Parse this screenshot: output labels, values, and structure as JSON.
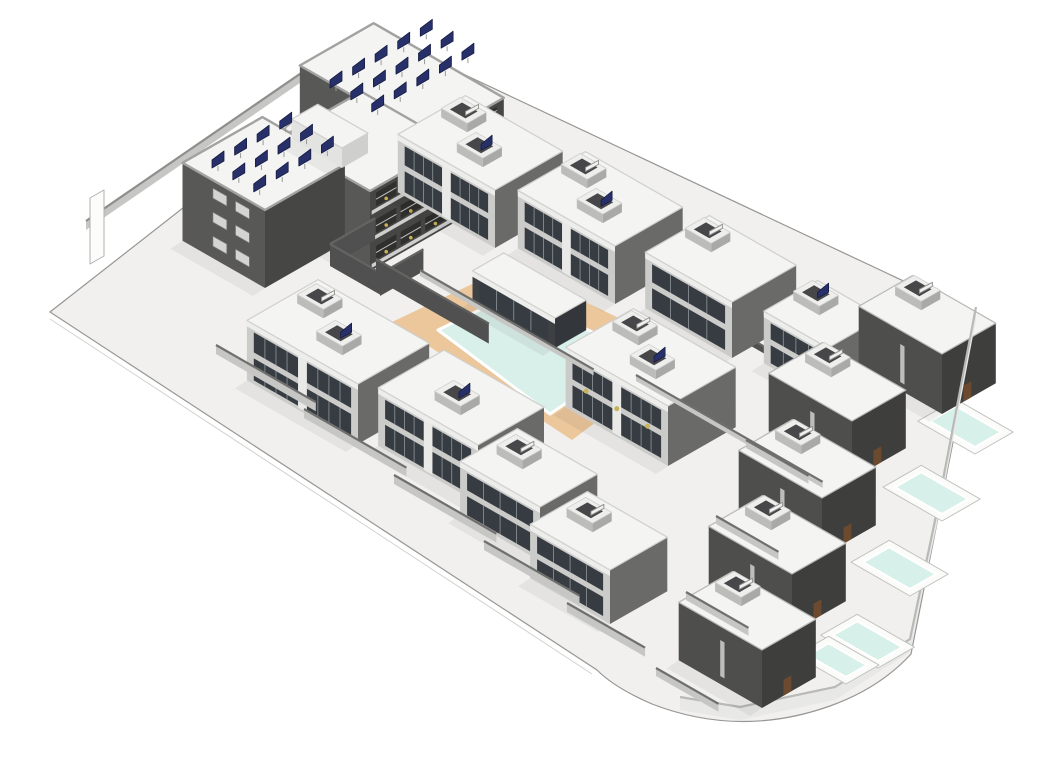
{
  "render": {
    "kind": "architectural-3d-site-render",
    "width": 1057,
    "height": 747
  },
  "palette": {
    "page_bg": "#ffffff",
    "ground": "#f1f0ee",
    "ground_edge": "#969694",
    "ground_edge_faint": "#d2d2d0",
    "roof_white": "#f4f4f2",
    "roof_stroke": "#cfcfcd",
    "hotel_sw": "#585856",
    "hotel_se": "#464644",
    "hotel_parapet": "#a2a2a0",
    "villa_sw": "#cbcbc9",
    "villa_se": "#6a6a68",
    "villa_fascia": "#ededeb",
    "dark_sw": "#4e4e4c",
    "dark_se": "#3e3e3c",
    "pavilion_sw": "#3d4144",
    "pavilion_se": "#33363a",
    "glass": "#363c42",
    "glass_frame": "#8f979b",
    "mullion_white": "#e9e9e7",
    "well_sw": "#bcbcba",
    "well_se": "#a9a9a7",
    "well_top": "#eeeeec",
    "well_inner": "#47474a",
    "solar_navy": "#273069",
    "solar_stroke": "#161c45",
    "equip_white": "#f1f1ef",
    "equip_stroke": "#8e8e8c",
    "deck_tan": "#ecc79c",
    "deck_step": "#d9aa74",
    "water_main": "#d9efe9",
    "water_rim": "#ffffff",
    "pool_slab": "#fbfbf9",
    "pool_slab_stroke": "#c2c2c0",
    "pool_water": "#d8f0ea",
    "low_wall_face": "#c6c6c4",
    "low_wall_cap": "#6f6f6d",
    "dark_wall_face": "#505050",
    "dark_wall_cap": "#646462",
    "bound_face": "#e8e8e6",
    "bound_cap": "#b9b9b7",
    "balcony_slab": "#cfcfcd",
    "balcony_dark": "#2f2f2d",
    "balcony_rail": "#bfbfbd",
    "plant_yellow": "#c9b357",
    "louver": "#d4d4d2",
    "louver_line": "#77777f",
    "shadow": "rgba(0,0,0,0.05)"
  },
  "scene": {
    "ground_path": "M355,26 L938,300 L871,638 Q840,672 790,690 Q700,722 612,688 Q575,672 557,654 L10,296 Z",
    "ground_step_line": "M10,303 L552,658",
    "curve_curb": "M866,636 Q836,668 788,686 Q702,718 616,684",
    "deck_steps": "M436,262 L466,247 M431,268 L462,252 M426,274 L458,257",
    "elements": [
      {
        "kind": "wallpath",
        "name": "left-boundary-wall",
        "pts": [
          [
            46,
            214
          ],
          [
            334,
            16
          ]
        ],
        "h": 9,
        "face": "@low_wall_face",
        "cap": "@equip_stroke"
      },
      {
        "kind": "flat",
        "name": "entrance-sign",
        "pts": [
          [
            50,
            182
          ],
          [
            64,
            174
          ],
          [
            64,
            240
          ],
          [
            50,
            248
          ]
        ],
        "fill": "#fcfcfa",
        "stroke": "#b0b0ae"
      },
      {
        "kind": "box",
        "name": "hotel-wing-north",
        "c": [
          390,
          195
        ],
        "wa": 150,
        "wb": 85,
        "h": 71,
        "style": "hotel",
        "balconies": true
      },
      {
        "kind": "box",
        "name": "hotel-wing-middle",
        "c": [
          330,
          255
        ],
        "wa": 105,
        "wb": 95,
        "h": 80,
        "style": "hotel",
        "balconies": true
      },
      {
        "kind": "box",
        "name": "hotel-wing-west",
        "c": [
          225,
          272
        ],
        "wa": 95,
        "wb": 92,
        "h": 78,
        "style": "hotel",
        "louvers": true
      },
      {
        "kind": "box",
        "name": "hotel-penthouse",
        "c": [
          302,
          152
        ],
        "wa": 58,
        "wb": 30,
        "h": 20,
        "style": "white"
      },
      {
        "kind": "panels",
        "name": "solar-array-north-roof",
        "o": [
          290,
          72
        ],
        "rows": 3,
        "cols": 5,
        "sa": 24,
        "sb": 26
      },
      {
        "kind": "panels",
        "name": "solar-array-west-roof",
        "o": [
          172,
          152
        ],
        "rows": 3,
        "cols": 4,
        "sa": 24,
        "sb": 26
      },
      {
        "kind": "wall",
        "name": "back-wall-villa-row",
        "c": [
          428,
          168
        ],
        "dir": "A",
        "len": 440,
        "h": 7,
        "face": "@dark_wall_face",
        "cap": "@dark_wall_cap"
      },
      {
        "kind": "flat",
        "name": "pool-deck",
        "pts": [
          [
            352,
            306
          ],
          [
            470,
            250
          ],
          [
            650,
            336
          ],
          [
            532,
            424
          ]
        ],
        "fill": "@deck_tan"
      },
      {
        "kind": "line",
        "name": "pool-deck-steps",
        "d": "@deck_steps",
        "stroke": "@deck_step",
        "w": 2
      },
      {
        "kind": "water",
        "name": "main-pool-water",
        "pts": [
          [
            398,
            314
          ],
          [
            452,
            288
          ],
          [
            462,
            296
          ],
          [
            486,
            284
          ],
          [
            598,
            338
          ],
          [
            510,
            398
          ]
        ]
      },
      {
        "kind": "wall",
        "name": "courtyard-wall-west",
        "c": [
          290,
          250
        ],
        "dir": "B",
        "len": 52,
        "h": 22,
        "face": "@dark_wall_face",
        "cap": "@dark_wall_cap"
      },
      {
        "kind": "wall",
        "name": "courtyard-wall-south",
        "c": [
          290,
          250
        ],
        "dir": "A",
        "len": 58,
        "h": 22,
        "face": "@dark_wall_face",
        "cap": "@dark_wall_cap"
      },
      {
        "kind": "wall",
        "name": "courtyard-wall-east",
        "c": [
          340,
          280
        ],
        "dir": "B",
        "len": 50,
        "h": 22,
        "face": "@dark_wall_face",
        "cap": "@dark_wall_cap"
      },
      {
        "kind": "wall",
        "name": "pool-terrace-wall",
        "c": [
          336,
          263
        ],
        "dir": "A",
        "len": 130,
        "h": 20,
        "face": "@dark_wall_face",
        "cap": "@dark_wall_cap"
      },
      {
        "kind": "box",
        "name": "villa-duplex-1",
        "c": [
          455,
          232
        ],
        "wa": 112,
        "wb": 78,
        "h": 58,
        "style": "light",
        "glass": true,
        "wells": [
          {
            "ta": 74,
            "tb": 42,
            "solar": false
          },
          {
            "ta": 30,
            "tb": 16,
            "solar": true
          }
        ]
      },
      {
        "kind": "box",
        "name": "villa-duplex-2",
        "c": [
          575,
          288
        ],
        "wa": 112,
        "wb": 78,
        "h": 58,
        "style": "light",
        "glass": true,
        "wells": [
          {
            "ta": 74,
            "tb": 42,
            "solar": false
          },
          {
            "ta": 30,
            "tb": 16,
            "solar": true
          }
        ]
      },
      {
        "kind": "box",
        "name": "villa-duplex-3",
        "c": [
          692,
          342
        ],
        "wa": 100,
        "wb": 74,
        "h": 56,
        "style": "light",
        "glass": true,
        "wells": [
          {
            "ta": 62,
            "tb": 38,
            "solar": false
          }
        ]
      },
      {
        "kind": "box",
        "name": "villa-4",
        "c": [
          788,
          384
        ],
        "wa": 74,
        "wb": 62,
        "h": 52,
        "style": "light",
        "glass": true,
        "wells": [
          {
            "ta": 38,
            "tb": 28,
            "solar": true
          }
        ]
      },
      {
        "kind": "pool",
        "name": "private-pool-corner",
        "c": [
          935,
          438
        ],
        "wa": 66,
        "wb": 44
      },
      {
        "kind": "box",
        "name": "corner-villa",
        "c": [
          902,
          398
        ],
        "wa": 96,
        "wb": 62,
        "h": 60,
        "style": "dark",
        "wells": [
          {
            "ta": 56,
            "tb": 32,
            "solar": false
          }
        ]
      },
      {
        "kind": "wallpath",
        "name": "right-boundary-wall",
        "pts": [
          [
            936,
            304
          ],
          [
            897,
            508
          ],
          [
            870,
            636
          ],
          [
            795,
            684
          ],
          [
            700,
            704
          ],
          [
            640,
            694
          ]
        ],
        "h": 13,
        "face": "@bound_face",
        "cap": "@bound_cap"
      },
      {
        "kind": "pool",
        "name": "private-pool-1",
        "c": [
          902,
          505
        ],
        "wa": 68,
        "wb": 44
      },
      {
        "kind": "box",
        "name": "dark-villa-1",
        "c": [
          812,
          463
        ],
        "wa": 96,
        "wb": 62,
        "h": 58,
        "style": "dark",
        "wells": [
          {
            "ta": 56,
            "tb": 32,
            "solar": false
          }
        ]
      },
      {
        "kind": "pool",
        "name": "private-pool-2",
        "c": [
          870,
          580
        ],
        "wa": 68,
        "wb": 44
      },
      {
        "kind": "box",
        "name": "dark-villa-2",
        "c": [
          782,
          540
        ],
        "wa": 96,
        "wb": 62,
        "h": 58,
        "style": "dark",
        "wells": [
          {
            "ta": 56,
            "tb": 32,
            "solar": false
          }
        ]
      },
      {
        "kind": "pool",
        "name": "private-pool-3",
        "c": [
          838,
          652
        ],
        "wa": 66,
        "wb": 42,
        "h": 0
      },
      {
        "kind": "box",
        "name": "dark-villa-3",
        "c": [
          752,
          616
        ],
        "wa": 96,
        "wb": 62,
        "h": 58,
        "style": "dark",
        "wells": [
          {
            "ta": 56,
            "tb": 32,
            "solar": false
          }
        ]
      },
      {
        "kind": "pool",
        "name": "private-pool-4",
        "c": [
          806,
          668
        ],
        "wa": 58,
        "wb": 38
      },
      {
        "kind": "box",
        "name": "dark-villa-4",
        "c": [
          722,
          692
        ],
        "wa": 96,
        "wb": 62,
        "h": 58,
        "style": "dark",
        "wells": [
          {
            "ta": 56,
            "tb": 32,
            "solar": false
          }
        ]
      },
      {
        "kind": "box",
        "name": "pool-house",
        "c": [
          515,
          332
        ],
        "wa": 95,
        "wb": 36,
        "h": 30,
        "style": "pavilion",
        "glass": true
      },
      {
        "kind": "box",
        "name": "villa-duplex-4",
        "c": [
          628,
          450
        ],
        "wa": 118,
        "wb": 78,
        "h": 60,
        "style": "light",
        "glass": true,
        "plants": true,
        "wells": [
          {
            "ta": 78,
            "tb": 44,
            "solar": false
          },
          {
            "ta": 34,
            "tb": 20,
            "solar": true
          }
        ]
      },
      {
        "kind": "box",
        "name": "villa-duplex-5",
        "c": [
          318,
          428
        ],
        "wa": 128,
        "wb": 82,
        "h": 60,
        "style": "light",
        "glass": true,
        "wells": [
          {
            "ta": 86,
            "tb": 46,
            "solar": false
          },
          {
            "ta": 38,
            "tb": 20,
            "solar": true
          }
        ]
      },
      {
        "kind": "box",
        "name": "villa-duplex-6",
        "c": [
          438,
          487
        ],
        "wa": 115,
        "wb": 76,
        "h": 58,
        "style": "light",
        "glass": true,
        "wells": [
          {
            "ta": 40,
            "tb": 20,
            "solar": true
          }
        ]
      },
      {
        "kind": "box",
        "name": "villa-5",
        "c": [
          500,
          545
        ],
        "wa": 92,
        "wb": 66,
        "h": 54,
        "style": "light",
        "glass": true,
        "wells": [
          {
            "ta": 48,
            "tb": 28,
            "solar": false
          }
        ]
      },
      {
        "kind": "box",
        "name": "villa-6",
        "c": [
          570,
          608
        ],
        "wa": 92,
        "wb": 66,
        "h": 54,
        "style": "light",
        "glass": true,
        "wells": [
          {
            "ta": 48,
            "tb": 28,
            "solar": false
          }
        ]
      },
      {
        "kind": "wall",
        "name": "garden-wall-1",
        "c": [
          176,
          338
        ],
        "dir": "A",
        "len": 115,
        "h": 9,
        "face": "@low_wall_face",
        "cap": "@low_wall_cap"
      },
      {
        "kind": "wall",
        "name": "garden-wall-2",
        "c": [
          264,
          402
        ],
        "dir": "A",
        "len": 118,
        "h": 9,
        "face": "@low_wall_face",
        "cap": "@low_wall_cap"
      },
      {
        "kind": "wall",
        "name": "garden-wall-3",
        "c": [
          354,
          468
        ],
        "dir": "A",
        "len": 118,
        "h": 9,
        "face": "@low_wall_face",
        "cap": "@low_wall_cap"
      },
      {
        "kind": "wall",
        "name": "garden-wall-4",
        "c": [
          444,
          534
        ],
        "dir": "A",
        "len": 110,
        "h": 9,
        "face": "@low_wall_face",
        "cap": "@low_wall_cap"
      },
      {
        "kind": "wall",
        "name": "garden-wall-5",
        "c": [
          527,
          596
        ],
        "dir": "A",
        "len": 90,
        "h": 9,
        "face": "@low_wall_face",
        "cap": "@low_wall_cap"
      },
      {
        "kind": "wall",
        "name": "row-front-wall-1",
        "c": [
          380,
          260
        ],
        "dir": "A",
        "len": 200,
        "h": 6,
        "face": "@low_wall_face",
        "cap": "@low_wall_cap"
      },
      {
        "kind": "wall",
        "name": "row-front-wall-2",
        "c": [
          596,
          365
        ],
        "dir": "A",
        "len": 215,
        "h": 6,
        "face": "@low_wall_face",
        "cap": "@low_wall_cap"
      },
      {
        "kind": "wall",
        "name": "drive-wall-1",
        "c": [
          706,
          432
        ],
        "dir": "A",
        "len": 72,
        "h": 8,
        "face": "@low_wall_face",
        "cap": "@low_wall_cap"
      },
      {
        "kind": "wall",
        "name": "drive-wall-2",
        "c": [
          676,
          508
        ],
        "dir": "A",
        "len": 72,
        "h": 8,
        "face": "@low_wall_face",
        "cap": "@low_wall_cap"
      },
      {
        "kind": "wall",
        "name": "drive-wall-3",
        "c": [
          646,
          584
        ],
        "dir": "A",
        "len": 72,
        "h": 8,
        "face": "@low_wall_face",
        "cap": "@low_wall_cap"
      },
      {
        "kind": "wall",
        "name": "drive-wall-4",
        "c": [
          616,
          660
        ],
        "dir": "A",
        "len": 72,
        "h": 8,
        "face": "@low_wall_face",
        "cap": "@low_wall_cap"
      },
      {
        "kind": "line",
        "name": "curved-curb-line",
        "d": "@curve_curb",
        "stroke": "#afafad",
        "w": 2
      }
    ]
  }
}
